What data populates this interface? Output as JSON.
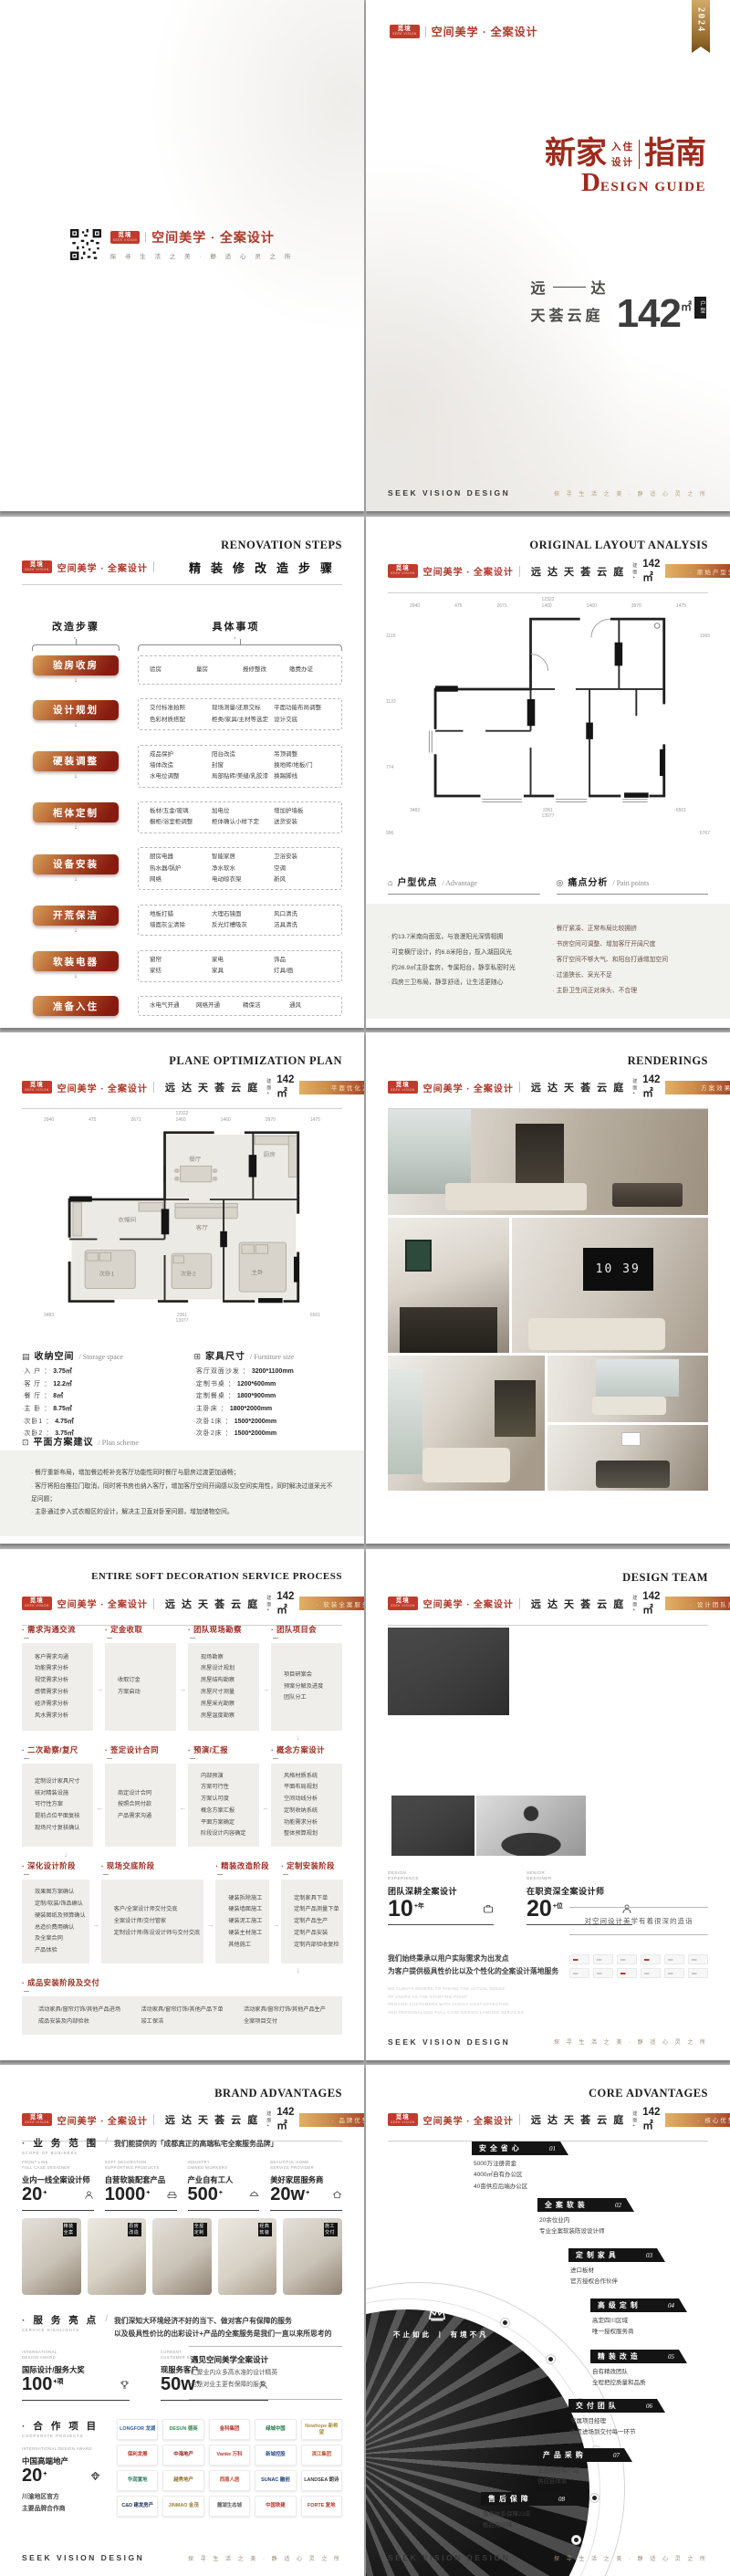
{
  "brand": {
    "logo_text": "觅境",
    "logo_sub": "SEEK VISION",
    "name_cn": "空间美学 · 全案设计",
    "name_en": "SEEK VISION DESIGN",
    "slogan": "探 寻 生 活 之 美 · 静 适 心 灵 之 所",
    "project": "远 达 天 荟 云 庭",
    "area_label": "建面+",
    "area": "142㎡",
    "year": "2024"
  },
  "back_cover": {
    "slogan": "探 寻 生 活 之 美 · 静 适 心 灵 之 所"
  },
  "cover": {
    "title_zh_1": "新家",
    "title_stack_1": "入住",
    "title_stack_2": "设计",
    "title_zh_2": "指南",
    "title_en_big": "D",
    "title_en_rest": "ESIGN GUIDE",
    "proj_l": "远",
    "proj_r": "达",
    "proj_line2": "天荟云庭",
    "area_num": "142",
    "area_unit": "㎡",
    "area_tag": "户型"
  },
  "reno": {
    "title_en": "RENOVATION STEPS",
    "title_cn": "精装修改造步骤",
    "col_left": "改造步骤",
    "col_right": "具体事项",
    "steps": [
      {
        "label": "验房收房",
        "cols": "4",
        "items": [
          "验房",
          "量房",
          "报修整改",
          "缴费办证"
        ]
      },
      {
        "label": "设计规划",
        "cols": "3",
        "items": [
          "交付标准拍照",
          "现场测量/还原交标",
          "平面功能布局调整",
          "色彩材质搭配",
          "柜类/家具/主材等选定",
          "设计交底"
        ]
      },
      {
        "label": "硬装调整",
        "cols": "3",
        "items": [
          "成品保护",
          "阳台改造",
          "吊顶调整",
          "墙体改造",
          "封窗",
          "换地砖/地板/门",
          "水电位调整",
          "局部贴砖/美缝/乳胶漆",
          "换踢脚线"
        ]
      },
      {
        "label": "柜体定制",
        "cols": "3",
        "items": [
          "板材/五金/玻璃",
          "加电位",
          "增加护墙板",
          "橱柜/浴室柜调整",
          "柜体确认小样下定",
          "送货安装"
        ]
      },
      {
        "label": "设备安装",
        "cols": "3",
        "items": [
          "厨房电器",
          "智能家居",
          "卫浴安装",
          "热水器/锅炉",
          "净水软水",
          "空调",
          "网络",
          "电动晾衣架",
          "新风"
        ]
      },
      {
        "label": "开荒保洁",
        "cols": "3",
        "items": [
          "地板打蜡",
          "大理石镜面",
          "风口清洗",
          "墙面灰尘清除",
          "反光灯槽吸灰",
          "洁具清洗"
        ]
      },
      {
        "label": "软装电器",
        "cols": "3",
        "items": [
          "窗帘",
          "家电",
          "饰品",
          "家纺",
          "家具",
          "灯具/画"
        ]
      },
      {
        "label": "准备入住",
        "cols": "4",
        "items": [
          "水电气开通",
          "网络开通",
          "精保洁",
          "通风"
        ]
      }
    ]
  },
  "original": {
    "title_en": "ORIGINAL LAYOUT ANALYSIS",
    "badge": "· 原始户型分析 ·",
    "plan": {
      "total_top": "12322",
      "top_dims": [
        "2940",
        "475",
        "2671",
        "1460",
        "1460",
        "3970",
        "1475"
      ],
      "left_dims": [
        "1115",
        "1122",
        "774",
        "996"
      ],
      "right_dims": [
        "1065",
        "6767"
      ],
      "bottom_dims": [
        "3483",
        "2361",
        "6501"
      ],
      "total_bottom": "13977"
    },
    "advantage": {
      "title": "户型优点",
      "en": "/ Advantage",
      "items": [
        "约13.7米南向面宽，与浪漫阳光深情相拥",
        "可变横厅设计，约6.8米阳台，揽入湖园风光",
        "约26.9㎡主卧套房，专属阳台，静享私密时光",
        "四房三卫布局，静享舒适，让生活更随心"
      ]
    },
    "pain": {
      "title": "痛点分析",
      "en": "/ Pain points",
      "items": [
        "餐厅紧凑、正常布局比较拥挤",
        "书房空间可调整、增加客厅开阔尺度",
        "客厅空间不够大气、和阳台打通增加空间",
        "过道狭长、采光不足",
        "主卧卫生间正对床头、不合理"
      ]
    }
  },
  "plane": {
    "title_en": "PLANE OPTIMIZATION PLAN",
    "badge": "· 平面优化方案 ·",
    "plan": {
      "total_top": "12322",
      "top_dims": [
        "2940",
        "475",
        "2671",
        "1460",
        "1460",
        "3970",
        "1475"
      ],
      "bottom_dims": [
        "3483",
        "2361",
        "6501"
      ],
      "total_bottom": "13977"
    },
    "storage": {
      "title": "收纳空间",
      "en": "/ Storage space",
      "items": [
        {
          "k": "入 户",
          "v": "3.75㎡"
        },
        {
          "k": "客 厅",
          "v": "12.2㎡"
        },
        {
          "k": "餐 厅",
          "v": "8㎡"
        },
        {
          "k": "主 卧",
          "v": "8.75㎡"
        },
        {
          "k": "次卧1",
          "v": "4.75㎡"
        },
        {
          "k": "次卧2",
          "v": "3.75㎡"
        }
      ]
    },
    "furniture": {
      "title": "家具尺寸",
      "en": "/ Furniture size",
      "items": [
        {
          "k": "客厅双面沙发",
          "v": "3200*1100mm"
        },
        {
          "k": "定制书桌",
          "v": "1200*600mm"
        },
        {
          "k": "定制餐桌",
          "v": "1800*900mm"
        },
        {
          "k": "主卧床",
          "v": "1800*2000mm"
        },
        {
          "k": "次卧1床",
          "v": "1500*2000mm"
        },
        {
          "k": "次卧2床",
          "v": "1500*2000mm"
        }
      ]
    },
    "scheme": {
      "title": "平面方案建议",
      "en": "/ Plan scheme",
      "items": [
        "餐厅重新布局，增加餐边柜补充客厅功能性同时餐厅与厨房过渡更加通畅；",
        "客厅将阳台推拉门取消，同时将书房也纳入客厅，增加客厅空间开阔感以及空间实用性，同时解决过道采光不足问题；",
        "主卧通过步入式衣帽区的设计，解决主卫直对卧室问题，增加储物空间。"
      ]
    }
  },
  "renderings": {
    "title_en": "RENDERINGS",
    "badge": "· 方案效果图 ·",
    "tv_clock": "10 39"
  },
  "process": {
    "title_en": "ENTIRE SOFT DECORATION SERVICE PROCESS",
    "badge": "· 软装全案服务流程 ·",
    "row1": [
      {
        "label": "需求沟通交流",
        "items": [
          "客户需求沟通",
          "功能需求分析",
          "视觉需求分析",
          "感情需求分析",
          "经济需求分析",
          "风水需求分析"
        ]
      },
      {
        "label": "定金收取",
        "items": [
          "收取订金",
          "方案启动"
        ]
      },
      {
        "label": "团队现场勘察",
        "items": [
          "现场勘察",
          "房屋设计规划",
          "房屋结构勘察",
          "房屋尺寸测量",
          "房屋采光勘察",
          "房屋温度勘察"
        ]
      },
      {
        "label": "团队项目会",
        "items": [
          "项目研案会",
          "预案分解及进度",
          "团队分工"
        ]
      }
    ],
    "row2": [
      {
        "label": "二次勘察/复尺",
        "items": [
          "定制设计家具尺寸",
          "核对精装设施",
          "可行性方案",
          "提前点位平面复核",
          "现场尺寸复核确认"
        ]
      },
      {
        "label": "签定设计合同",
        "items": [
          "商定设计合同",
          "按照合同付款",
          "产品需求沟通"
        ]
      },
      {
        "label": "预演/汇报",
        "items": [
          "内部预演",
          "方案可行性",
          "方案认可度",
          "概念方案汇报",
          "平面方案确定",
          "阶段设计内容确定"
        ]
      },
      {
        "label": "概念方案设计",
        "items": [
          "风格材质系统",
          "平面布局规划",
          "空间动线分析",
          "定制收纳系统",
          "功能需求分析",
          "整体预算规划"
        ]
      }
    ],
    "row3": [
      {
        "label": "深化设计阶段",
        "items": [
          "效果图方案确认",
          "定制/软装/饰品确认",
          "硬装图纸及预算确认",
          "总造价费用确认",
          "及全案合同",
          "产品体验"
        ]
      },
      {
        "label": "现场交底阶段",
        "items": [
          "客户/全案设计师交付交底",
          "全案设计师/交付管家",
          "定制设计师/陈设设计师与交付交底"
        ]
      },
      {
        "label": "精装改造阶段",
        "items": [
          "硬装拆除施工",
          "硬装墙面施工",
          "硬装泥工施工",
          "硬装主材施工",
          "其他施工"
        ]
      },
      {
        "label": "定制安装阶段",
        "items": [
          "定制家具下单",
          "定制产品测量下单",
          "定制产品生产",
          "定制产品安装",
          "定制内部验收复检"
        ]
      }
    ],
    "final": {
      "label": "成品安装阶段及交付",
      "cols": [
        [
          "活动家具/窗帘灯饰/其他产品进场",
          "成品安装及内部验收"
        ],
        [
          "活动家具/窗帘灯饰/其他产品下单",
          "竣工保洁"
        ],
        [
          "活动家具/窗帘灯饰/其他产品生产",
          "全案项目交付"
        ]
      ]
    }
  },
  "team": {
    "title_en": "DESIGN TEAM",
    "badge": "· 设计团队展示 ·",
    "stat1": {
      "en1": "DESIGN",
      "en2": "EXPERIENCE",
      "label": "团队深耕全案设计",
      "num": "10",
      "sup": "+年"
    },
    "stat2": {
      "en1": "SENIOR",
      "en2": "DESIGNER",
      "label": "在职资深全案设计师",
      "num": "20",
      "sup": "+位"
    },
    "quote": "对空间设计美学有着很深的造诣",
    "para1": "我们始终秉承以用户实际需求为出发点",
    "para2": "为客户提供极具性价比以及个性化的全案设计落地服务",
    "para_en": [
      "WE ALWAYS ADHERE TO TAKING THE ACTUAL NEEDS",
      "OF USERS AS THE STARTING POINT",
      "PROVIDE CUSTOMERS WITH HIGHLY COST-EFFECTIVE",
      "AND PERSONALIZED FULL-CASE DESIGN LANDING SERVICES"
    ]
  },
  "brandadv": {
    "title_en": "BRAND ADVANTAGES",
    "badge": "· 品牌优势 ·",
    "scope": {
      "title": "业 务 范 围",
      "en": "SCOPE OF BUSINESS",
      "desc": "我们能提供的「成都真正的高端私宅全案服务品牌」",
      "stats": [
        {
          "en1": "FRONT LINE",
          "en2": "FULL CASE DESIGNER",
          "label": "业内一线全案设计师",
          "num": "20",
          "sup": "+"
        },
        {
          "en1": "SOFT DECORATION",
          "en2": "SUPPORTING PRODUCTS",
          "label": "自营软装配套产品",
          "num": "1000",
          "sup": "+"
        },
        {
          "en1": "INDUSTRY",
          "en2": "OWNED WORKERS",
          "label": "产业自有工人",
          "num": "500",
          "sup": "+"
        },
        {
          "en1": "BEAUTIFUL HOME",
          "en2": "SERVICE PROVIDER",
          "label": "美好家居服务商",
          "num": "20w",
          "sup": "+"
        }
      ],
      "cards": [
        "精装全案",
        "原房改造",
        "全屋定制",
        "经典软装",
        "施工交付"
      ]
    },
    "service": {
      "title": "服 务 亮 点",
      "en": "SERVICE HIGHLIGHTS",
      "desc1": "我们深知大环境经济不好的当下、做对客户有保障的服务",
      "desc2": "以及极具性价比的出彩设计+产品的全案服务是我们一直以来所思考的",
      "stats": [
        {
          "en1": "INTERNATIONAL",
          "en2": "DESIGN AWARD",
          "label": "国际设计/服务大奖",
          "num": "100",
          "sup": "+项"
        },
        {
          "en1": "CURRENT",
          "en2": "CUSTOMER SERVICE",
          "label": "现服务客户",
          "num": "50w",
          "sup": "+"
        }
      ],
      "meet_title": "遇见空间美学全案设计",
      "meet1": "汇聚业内众多高水准的设计精英",
      "meet2": "也是对业主更有保障的服务"
    },
    "coop": {
      "title": "合 作 项 目",
      "en": "COOPERATE PROJECTS",
      "en2": "INTERNATIONAL DESIGN AWARD",
      "label": "中国高端地产",
      "num": "20",
      "sup": "+",
      "note1": "川渝地区官方",
      "note2": "主要品牌合作商",
      "logos": [
        {
          "t": "LONGFOR 龙湖",
          "c": "#2e5fa3"
        },
        {
          "t": "DESUN 德商",
          "c": "#2f8f4e"
        },
        {
          "t": "金科集团",
          "c": "#b5382e"
        },
        {
          "t": "绿城中国",
          "c": "#1e7e4c"
        },
        {
          "t": "Newhope 新希望",
          "c": "#b08f3c"
        },
        {
          "t": "保利发展",
          "c": "#b5382e"
        },
        {
          "t": "中海地产",
          "c": "#8d2420"
        },
        {
          "t": "Vanke 万科",
          "c": "#c23a2f"
        },
        {
          "t": "新城控股",
          "c": "#2f4f8f"
        },
        {
          "t": "滨江集团",
          "c": "#c2542f"
        },
        {
          "t": "华润置地",
          "c": "#2f7f5f"
        },
        {
          "t": "越秀地产",
          "c": "#8f6f2f"
        },
        {
          "t": "西南人居",
          "c": "#c2452f"
        },
        {
          "t": "SUNAC 融创",
          "c": "#1f3f7f"
        },
        {
          "t": "LANDSEA 朗诗",
          "c": "#3f3f3f"
        },
        {
          "t": "C&D 建发房产",
          "c": "#24365e"
        },
        {
          "t": "JINMAO 金茂",
          "c": "#9f7f3f"
        },
        {
          "t": "麓湖生态城",
          "c": "#5f5f5f"
        },
        {
          "t": "中国铁建",
          "c": "#b5382e"
        },
        {
          "t": "FORTE 复地",
          "c": "#b5382e"
        }
      ]
    }
  },
  "core": {
    "title_en": "CORE ADVANTAGES",
    "badge": "· 核心优势 ·",
    "overlay": "不止如此 丨 有境不凡",
    "items": [
      {
        "no": "01",
        "label": "安 全 省 心",
        "items": [
          "5000万注册资金",
          "4000㎡自有办公区",
          "40亩供应后端办公区"
        ]
      },
      {
        "no": "02",
        "label": "全 案 软 装",
        "items": [
          "20余位业内",
          "专业全案软装陈设设计师"
        ]
      },
      {
        "no": "03",
        "label": "定 制 家 具",
        "items": [
          "进口板材",
          "官方授权合作伙伴"
        ]
      },
      {
        "no": "04",
        "label": "高 级 定 制",
        "items": [
          "高定四川区域",
          "唯一授权服务商"
        ]
      },
      {
        "no": "05",
        "label": "精 装 改 造",
        "items": [
          "自有精改团队",
          "全程把控质量和品质"
        ]
      },
      {
        "no": "06",
        "label": "交 付 团 队",
        "items": [
          "专属项目经理",
          "负责进场到交付每一环节"
        ]
      },
      {
        "no": "07",
        "label": "产 品 采 购",
        "items": [
          "上万件自有产品",
          "供应链体系"
        ]
      },
      {
        "no": "08",
        "label": "售 后 保 障",
        "items": [
          "服务体系保障23年",
          "售后有保障"
        ]
      }
    ]
  }
}
